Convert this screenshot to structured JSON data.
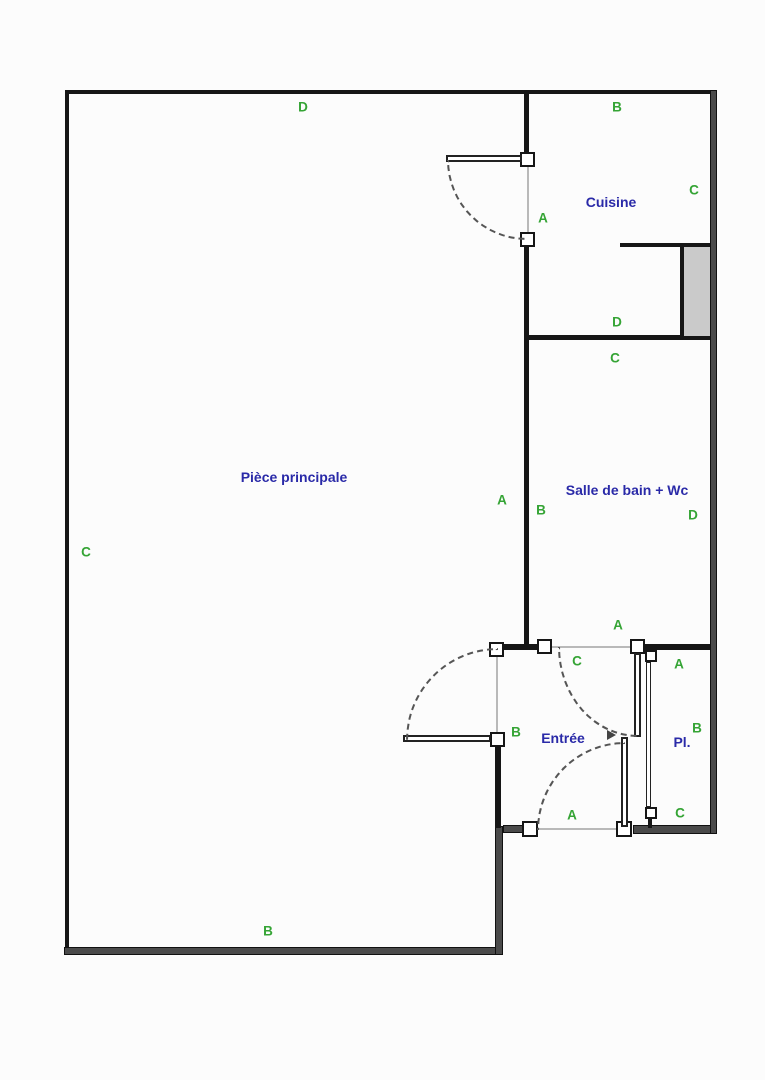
{
  "document": {
    "type": "apartment-floor-plan",
    "background": "#fcfcfc"
  },
  "colors": {
    "interior_wall": "#161616",
    "outer_wall_fill": "#4a4a4a",
    "room_label_text": "#2a2aa8",
    "wall_mark_text": "#35a435",
    "appliance_fill": "#cacaca",
    "door_opening_line": "#b9b9b9"
  },
  "rooms": {
    "piece_principale": {
      "label": "Pièce principale"
    },
    "cuisine": {
      "label": "Cuisine"
    },
    "salle_de_bain": {
      "label": "Salle de bain + Wc"
    },
    "entree": {
      "label": "Entrée"
    },
    "placard": {
      "label": "Pl."
    }
  },
  "marks": [
    {
      "label": "D"
    },
    {
      "label": "B"
    },
    {
      "label": "C"
    },
    {
      "label": "A"
    },
    {
      "label": "D"
    },
    {
      "label": "C"
    },
    {
      "label": "A"
    },
    {
      "label": "B"
    },
    {
      "label": "D"
    },
    {
      "label": "C"
    },
    {
      "label": "A"
    },
    {
      "label": "C"
    },
    {
      "label": "A"
    },
    {
      "label": "B"
    },
    {
      "label": "B"
    },
    {
      "label": "A"
    },
    {
      "label": "C"
    },
    {
      "label": "B"
    }
  ]
}
